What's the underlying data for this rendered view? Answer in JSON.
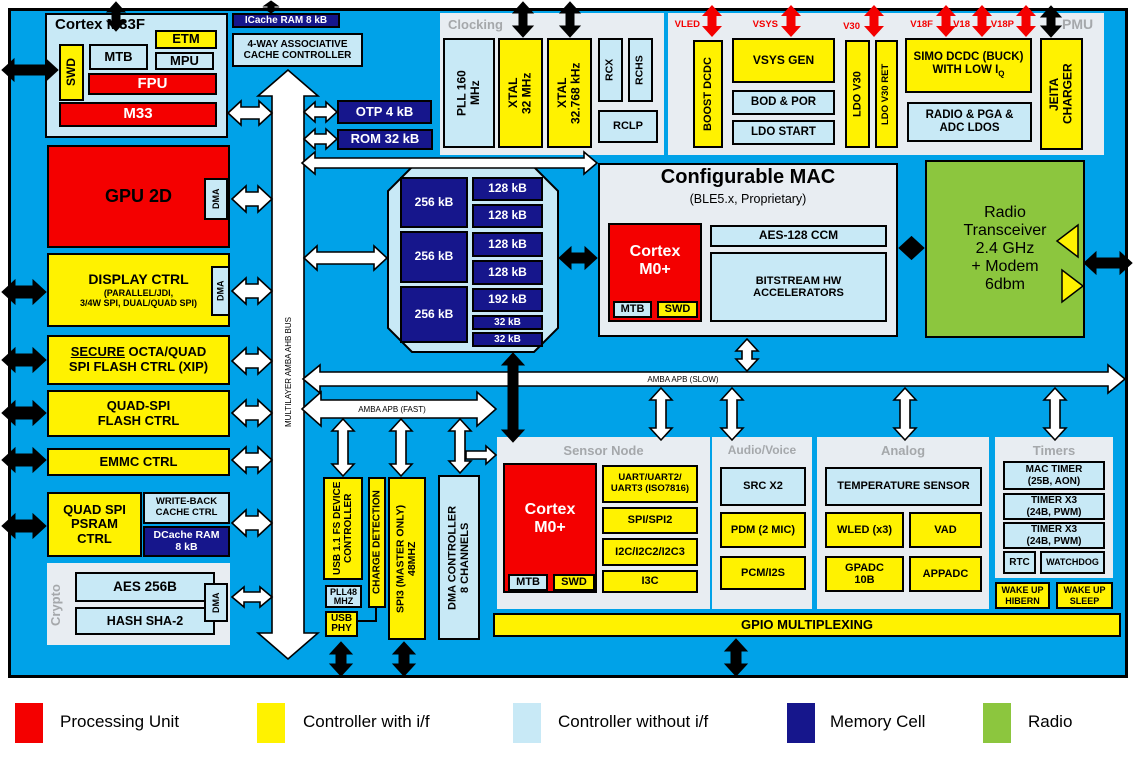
{
  "colors": {
    "bg": "#00A2E8",
    "red": "#F40000",
    "yellow": "#FFF200",
    "lb": "#C8E9F6",
    "navy": "#16168C",
    "green": "#8CC63E",
    "panel": "#E8EDF2",
    "gray": "#A5A8AB"
  },
  "m33f": {
    "title": "Cortex M33F",
    "swd": "SWD",
    "mtb": "MTB",
    "etm": "ETM",
    "mpu": "MPU",
    "fpu": "FPU",
    "core": "M33"
  },
  "cache": {
    "icache": "ICache RAM 8 kB",
    "controller": "4-WAY ASSOCIATIVE\nCACHE CONTROLLER",
    "otp": "OTP 4 kB",
    "rom": "ROM 32 kB"
  },
  "clocking": {
    "label": "Clocking",
    "pll": "PLL 160\nMHz",
    "xtal_32m": "XTAL\n32 MHz",
    "xtal_32k": "XTAL\n32.768 kHz",
    "rcx": "RCX",
    "rchs": "RCHS",
    "rclp": "RCLP"
  },
  "pmu": {
    "label": "PMU",
    "rails": [
      "VLED",
      "VSYS",
      "V30",
      "V18F",
      "V18",
      "V18P"
    ],
    "boost_dcdc": "BOOST DCDC",
    "vsys_gen": "VSYS GEN",
    "bod_por": "BOD & POR",
    "ldo_start": "LDO START",
    "ldo_v30": "LDO V30",
    "ldo_v30_ret": "LDO V30 RET",
    "simo_main": "SIMO DCDC (BUCK)",
    "simo_line2": "WITH LOW I",
    "simo_sub": "Q",
    "radio_ldos": "RADIO & PGA &\nADC LDOS",
    "jeita": "JEITA\nCHARGER"
  },
  "left_column": {
    "gpu": "GPU 2D",
    "gpu_dma": "DMA",
    "display_title": "DISPLAY CTRL",
    "display_sub": "(PARALLEL/JDI,\n3/4W SPI, DUAL/QUAD SPI)",
    "display_dma": "DMA",
    "secure_word": "SECURE",
    "secure_rest": " OCTA/QUAD\nSPI FLASH CTRL (XIP)",
    "quad_spi": "QUAD-SPI\nFLASH CTRL",
    "emmc": "EMMC CTRL",
    "psram": "QUAD SPI\nPSRAM\nCTRL",
    "write_back": "WRITE-BACK\nCACHE CTRL",
    "dcache": "DCache RAM\n8 kB"
  },
  "crypto": {
    "label": "Crypto",
    "aes": "AES 256B",
    "hash": "HASH SHA-2",
    "dma": "DMA"
  },
  "memory": {
    "left": [
      "256 kB",
      "256 kB",
      "256 kB"
    ],
    "right": [
      "128 kB",
      "128 kB",
      "128 kB",
      "128 kB",
      "192 kB",
      "32 kB",
      "32 kB"
    ]
  },
  "mac": {
    "title": "Configurable MAC",
    "subtitle": "(BLE5.x, Proprietary)",
    "core": "Cortex\nM0+",
    "mtb": "MTB",
    "swd": "SWD",
    "aes": "AES-128 CCM",
    "bitstream": "BITSTREAM HW\nACCELERATORS"
  },
  "radio": {
    "label": "Radio\nTransceiver\n2.4 GHz\n+ Modem\n6dbm"
  },
  "buses": {
    "ahb": "MULTILAYER AMBA AHB BUS",
    "apb_fast": "AMBA APB (FAST)",
    "apb_slow": "AMBA APB (SLOW)"
  },
  "usb_column": {
    "usb": "USB 1.1 FS DEVICE\nCONTROLLER",
    "pll48": "PLL48\nMHZ",
    "usb_phy": "USB\nPHY",
    "charge": "CHARGE DETECTION",
    "spi3": "SPI3 (MASTER ONLY)\n48MHZ",
    "dma_ctrl": "DMA CONTROLLER\n8 CHANNELS"
  },
  "sensor": {
    "label": "Sensor Node",
    "core": "Cortex\nM0+",
    "mtb": "MTB",
    "swd": "SWD",
    "uart": "UART/UART2/\nUART3 (ISO7816)",
    "spi": "SPI/SPI2",
    "i2c": "I2C/I2C2/I2C3",
    "i3c": "I3C"
  },
  "audio": {
    "label": "Audio/Voice",
    "src": "SRC X2",
    "pdm": "PDM (2 MIC)",
    "pcm": "PCM/I2S"
  },
  "analog": {
    "label": "Analog",
    "temp": "TEMPERATURE SENSOR",
    "wled": "WLED (x3)",
    "vad": "VAD",
    "gpadc": "GPADC\n10B",
    "appadc": "APPADC"
  },
  "timers": {
    "label": "Timers",
    "mac_timer": "MAC TIMER\n(25B, AON)",
    "timer1": "TIMER X3\n(24B, PWM)",
    "timer2": "TIMER X3\n(24B, PWM)",
    "rtc": "RTC",
    "watchdog": "WATCHDOG",
    "wake_hibern": "WAKE UP\nHIBERN",
    "wake_sleep": "WAKE UP\nSLEEP"
  },
  "gpio": {
    "label": "GPIO MULTIPLEXING"
  },
  "legend": {
    "items": [
      {
        "label": "Processing Unit",
        "color": "#F40000"
      },
      {
        "label": "Controller with i/f",
        "color": "#FFF200"
      },
      {
        "label": "Controller without i/f",
        "color": "#C8E9F6"
      },
      {
        "label": "Memory Cell",
        "color": "#16168C"
      },
      {
        "label": "Radio",
        "color": "#8CC63E"
      }
    ]
  }
}
